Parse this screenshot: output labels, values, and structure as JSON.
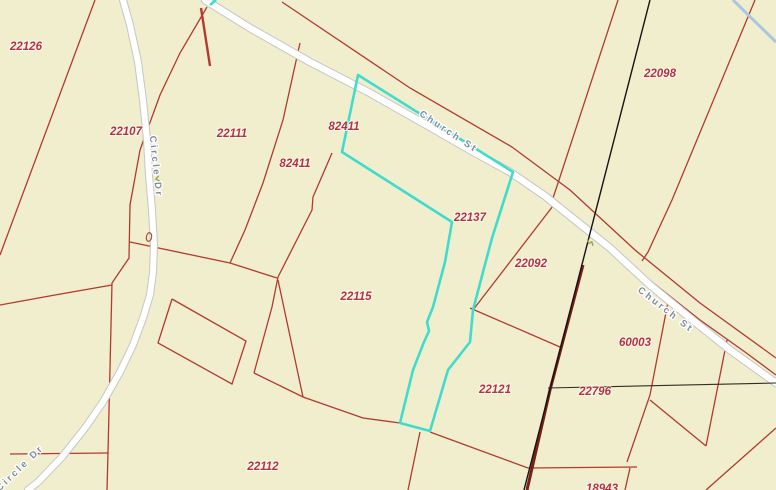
{
  "map": {
    "background_color": "#f1eecd",
    "parcel_line_color": "#b23a2e",
    "thick_line_color": "#7a1f16",
    "black_line_color": "#141414",
    "survey_line_color": "#2e2e24",
    "selection_color": "#3fdcce",
    "road_fill_color": "#ffffff",
    "road_casing_color": "#c6c6c6",
    "stream_color": "#aac6e1",
    "parcel_label_color": "#b5323c",
    "road_label_color": "#7d8c9b",
    "icon_color_culvert": "#9aa05f",
    "icon_color_structure": "#a1543f",
    "parcel_labels": [
      {
        "text": "22126",
        "x": 26,
        "y": 50
      },
      {
        "text": "22107",
        "x": 126,
        "y": 135
      },
      {
        "text": "22111",
        "x": 232,
        "y": 137
      },
      {
        "text": "82411",
        "x": 344,
        "y": 130
      },
      {
        "text": "82411",
        "x": 295,
        "y": 167
      },
      {
        "text": "22098",
        "x": 660,
        "y": 77
      },
      {
        "text": "22137",
        "x": 470,
        "y": 221
      },
      {
        "text": "22092",
        "x": 531,
        "y": 267
      },
      {
        "text": "22115",
        "x": 356,
        "y": 300
      },
      {
        "text": "60003",
        "x": 635,
        "y": 346
      },
      {
        "text": "22121",
        "x": 495,
        "y": 393
      },
      {
        "text": "22796",
        "x": 595,
        "y": 395
      },
      {
        "text": "22112",
        "x": 263,
        "y": 470
      },
      {
        "text": "18943",
        "x": 602,
        "y": 492
      }
    ],
    "road_labels": [
      {
        "text": "Church St",
        "x": 447,
        "y": 134,
        "rot": 33.5
      },
      {
        "text": "Church St",
        "x": 664,
        "y": 312,
        "rot": 38
      },
      {
        "text": "Circle Dr",
        "x": 153,
        "y": 167,
        "rot": 84
      },
      {
        "text": "Circle Dr",
        "x": 22,
        "y": 470,
        "rot": -44
      }
    ],
    "roads": [
      {
        "name": "church-st",
        "width": 6.5,
        "pts": [
          [
            205,
            0
          ],
          [
            250,
            28
          ],
          [
            310,
            62
          ],
          [
            370,
            93
          ],
          [
            430,
            127
          ],
          [
            470,
            150
          ],
          [
            510,
            172
          ],
          [
            545,
            196
          ],
          [
            575,
            220
          ],
          [
            610,
            248
          ],
          [
            650,
            285
          ],
          [
            690,
            318
          ],
          [
            730,
            350
          ],
          [
            776,
            383
          ]
        ]
      },
      {
        "name": "circle-dr",
        "width": 6,
        "pts": [
          [
            123,
            0
          ],
          [
            130,
            25
          ],
          [
            138,
            62
          ],
          [
            143,
            100
          ],
          [
            147,
            140
          ],
          [
            149,
            175
          ],
          [
            152,
            210
          ],
          [
            154,
            245
          ],
          [
            153,
            272
          ],
          [
            150,
            295
          ],
          [
            143,
            318
          ],
          [
            133,
            345
          ],
          [
            120,
            372
          ],
          [
            103,
            402
          ],
          [
            85,
            428
          ],
          [
            62,
            457
          ],
          [
            38,
            482
          ],
          [
            28,
            490
          ]
        ]
      }
    ],
    "stream": {
      "pts": [
        [
          733,
          0
        ],
        [
          776,
          42
        ]
      ],
      "width": 3
    },
    "black_lines": [
      {
        "pts": [
          [
            650,
            0
          ],
          [
            524,
            490
          ]
        ],
        "w": 1.4,
        "use": "black_line_color"
      },
      {
        "pts": [
          [
            548,
            388
          ],
          [
            776,
            383
          ]
        ],
        "w": 1.1,
        "use": "survey_line_color"
      }
    ],
    "thick_lines": [
      {
        "pts": [
          [
            583,
            265
          ],
          [
            550,
            390
          ],
          [
            527,
            490
          ]
        ],
        "w": 3
      }
    ],
    "parcel_lines": [
      {
        "pts": [
          [
            95,
            0
          ],
          [
            0,
            255
          ]
        ]
      },
      {
        "pts": [
          [
            201,
            8
          ],
          [
            210,
            66
          ]
        ],
        "w": 2.4
      },
      {
        "pts": [
          [
            207,
            7
          ],
          [
            180,
            53
          ],
          [
            160,
            95
          ],
          [
            140,
            150
          ],
          [
            130,
            205
          ],
          [
            129,
            258
          ],
          [
            112,
            283
          ],
          [
            108,
            453
          ],
          [
            107,
            490
          ]
        ]
      },
      {
        "pts": [
          [
            0,
            305
          ],
          [
            55,
            295
          ],
          [
            112,
            285
          ]
        ]
      },
      {
        "pts": [
          [
            10,
            454
          ],
          [
            108,
            453
          ]
        ]
      },
      {
        "pts": [
          [
            300,
            43
          ],
          [
            283,
            120
          ],
          [
            263,
            183
          ],
          [
            245,
            230
          ],
          [
            230,
            263
          ]
        ]
      },
      {
        "pts": [
          [
            130,
            242
          ],
          [
            230,
            263
          ],
          [
            277,
            278
          ]
        ]
      },
      {
        "pts": [
          [
            332,
            153
          ],
          [
            313,
            197
          ],
          [
            312,
            210
          ],
          [
            278,
            277
          ]
        ]
      },
      {
        "pts": [
          [
            278,
            277
          ],
          [
            272,
            307
          ],
          [
            263,
            340
          ],
          [
            254,
            373
          ]
        ]
      },
      {
        "pts": [
          [
            254,
            373
          ],
          [
            303,
            397
          ],
          [
            363,
            418
          ],
          [
            400,
            423
          ]
        ]
      },
      {
        "pts": [
          [
            278,
            280
          ],
          [
            303,
            397
          ]
        ]
      },
      {
        "pts": [
          [
            172,
            299
          ],
          [
            246,
            341
          ],
          [
            232,
            384
          ],
          [
            158,
            343
          ],
          [
            172,
            299
          ]
        ]
      },
      {
        "pts": [
          [
            430,
            432
          ],
          [
            528,
            468
          ]
        ]
      },
      {
        "pts": [
          [
            420,
            432
          ],
          [
            408,
            490
          ]
        ]
      },
      {
        "pts": [
          [
            282,
            2
          ],
          [
            410,
            88
          ],
          [
            512,
            147
          ],
          [
            570,
            190
          ],
          [
            635,
            250
          ],
          [
            700,
            303
          ],
          [
            776,
            358
          ]
        ]
      },
      {
        "pts": [
          [
            618,
            0
          ],
          [
            560,
            177
          ],
          [
            553,
            198
          ]
        ]
      },
      {
        "pts": [
          [
            755,
            0
          ],
          [
            672,
            200
          ],
          [
            648,
            252
          ],
          [
            642,
            261
          ]
        ]
      },
      {
        "pts": [
          [
            556,
            202
          ],
          [
            473,
            310
          ]
        ]
      },
      {
        "pts": [
          [
            470,
            308
          ],
          [
            560,
            347
          ]
        ]
      },
      {
        "pts": [
          [
            668,
            302
          ],
          [
            650,
            395
          ],
          [
            627,
            462
          ]
        ]
      },
      {
        "pts": [
          [
            528,
            468
          ],
          [
            637,
            467
          ]
        ]
      },
      {
        "pts": [
          [
            650,
            400
          ],
          [
            706,
            446
          ]
        ]
      },
      {
        "pts": [
          [
            706,
            446
          ],
          [
            727,
            340
          ]
        ]
      },
      {
        "pts": [
          [
            776,
            428
          ],
          [
            706,
            490
          ]
        ]
      },
      {
        "pts": [
          [
            630,
            468
          ],
          [
            625,
            490
          ]
        ]
      },
      {
        "pts": [
          [
            513,
            172
          ],
          [
            556,
            202
          ],
          [
            612,
            253
          ],
          [
            652,
            282
          ],
          [
            700,
            320
          ],
          [
            745,
            352
          ],
          [
            776,
            375
          ]
        ]
      }
    ],
    "selection": {
      "polygon": [
        [
          358,
          75
        ],
        [
          513,
          172
        ],
        [
          492,
          238
        ],
        [
          473,
          310
        ],
        [
          470,
          342
        ],
        [
          448,
          370
        ],
        [
          430,
          431
        ],
        [
          400,
          423
        ],
        [
          413,
          370
        ],
        [
          424,
          342
        ],
        [
          429,
          331
        ],
        [
          427,
          322
        ],
        [
          433,
          307
        ],
        [
          445,
          262
        ],
        [
          452,
          222
        ],
        [
          342,
          152
        ]
      ],
      "ticks": [
        [
          [
            210,
            5
          ],
          [
            216,
            0
          ]
        ]
      ],
      "width": 2.6
    },
    "icons": [
      {
        "name": "culvert-icon",
        "type": "culvert",
        "x": 157,
        "y": 180,
        "rot": 85
      },
      {
        "name": "structure-icon",
        "type": "structure",
        "x": 149,
        "y": 237,
        "rot": 10
      },
      {
        "name": "culvert-icon",
        "type": "culvert",
        "x": 590,
        "y": 243,
        "rot": 30
      }
    ]
  }
}
